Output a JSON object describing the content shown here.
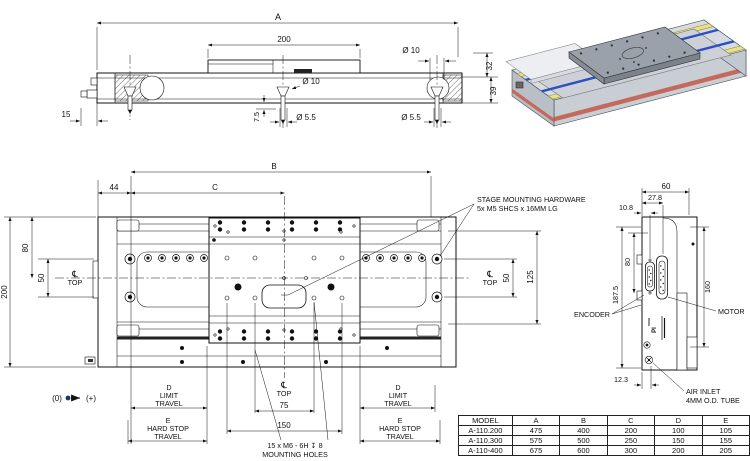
{
  "side_view": {
    "a": "A",
    "len200": "200",
    "dia10_r": "Ø 10",
    "h32": "32",
    "h39": "39",
    "off15": "15",
    "off7_5": "7.5",
    "dia5_5_c": "Ø 5.5",
    "dia10_c": "Ø 10",
    "dia5_5_r": "Ø 5.5"
  },
  "top_view": {
    "b": "B",
    "c": "C",
    "w44": "44",
    "h80": "80",
    "h50": "50",
    "h200": "200",
    "cl": "℄",
    "top": "TOP",
    "h50r": "50",
    "h125": "125",
    "d": [
      "D",
      "LIMIT",
      "TRAVEL"
    ],
    "e": [
      "E",
      "HARD STOP",
      "TRAVEL"
    ],
    "w75": "75",
    "w150": "150",
    "note_holes_1": "15 x  M6 - 6H ↧ 8",
    "note_holes_2": "MOUNTING HOLES",
    "note_hw_1": "STAGE MOUNTING HARDWARE",
    "note_hw_2": "5x M5 SHCS x 16MM LG",
    "origin_zero": "(0)",
    "origin_plus": "(+)"
  },
  "end_view": {
    "w60": "60",
    "w27_8": "27.8",
    "w10_8": "10.8",
    "h80": "80",
    "h187_5": "187.5",
    "h160": "160",
    "w12_3": "12.3",
    "encoder": "ENCODER",
    "motor": "MOTOR",
    "air_1": "AIR INLET",
    "air_2": "4MM O.D. TUBE",
    "marking": "PI"
  },
  "table": {
    "headers": [
      "MODEL",
      "A",
      "B",
      "C",
      "D",
      "E"
    ],
    "rows": [
      [
        "A-110.200",
        "475",
        "400",
        "200",
        "100",
        "105"
      ],
      [
        "A-110.300",
        "575",
        "500",
        "250",
        "150",
        "155"
      ],
      [
        "A-110-400",
        "675",
        "600",
        "300",
        "200",
        "205"
      ]
    ]
  },
  "colors": {
    "line": "#111111",
    "rail_blue": "#2b50c0",
    "side_yellow": "#e8e287",
    "stripe_red": "#c4695c",
    "origin_dot": "#123c63"
  }
}
